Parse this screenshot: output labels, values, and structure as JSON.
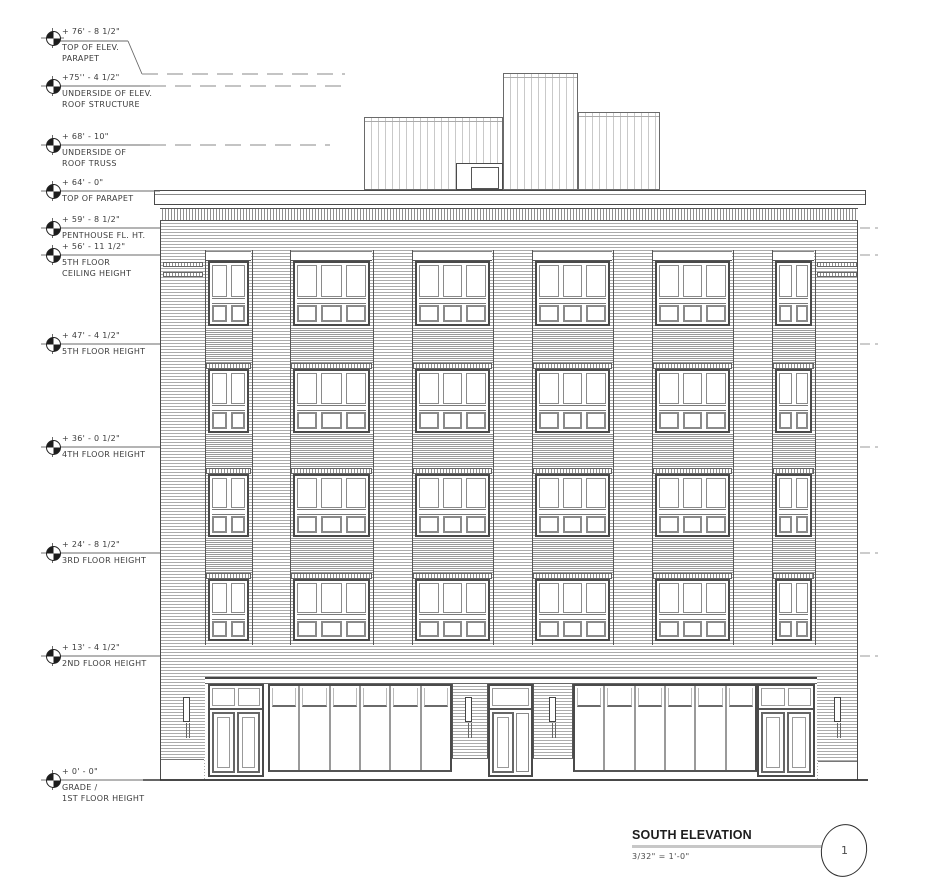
{
  "title_block": {
    "title": "SOUTH ELEVATION",
    "scale": "3/32\" = 1'-0\"",
    "bubble_number": "1"
  },
  "elevation_markers": [
    {
      "value": "+ 76' - 8 1/2\"",
      "lines": [
        "TOP OF ELEV.",
        "PARAPET"
      ],
      "y": 74,
      "leader": "roof",
      "end_x": 345
    },
    {
      "value": "+75'' - 4 1/2\"",
      "lines": [
        "UNDERSIDE OF ELEV.",
        "ROOF STRUCTURE"
      ],
      "y": 86,
      "leader": "dashed",
      "end_x": 345
    },
    {
      "value": "+ 68' - 10\"",
      "lines": [
        "UNDERSIDE OF",
        "ROOF TRUSS"
      ],
      "y": 145,
      "leader": "dashed",
      "end_x": 330
    },
    {
      "value": "+ 64' - 0\"",
      "lines": [
        "TOP OF PARAPET"
      ],
      "y": 191,
      "leader": "solid",
      "end_x": 160
    },
    {
      "value": "+ 59' - 8 1/2\"",
      "lines": [
        "PENTHOUSE FL. HT."
      ],
      "y": 228,
      "leader": "solid",
      "end_x": 160
    },
    {
      "value": "+ 56' - 11 1/2\"",
      "lines": [
        "5TH FLOOR",
        "CEILING HEIGHT"
      ],
      "y": 255,
      "leader": "solid",
      "end_x": 160
    },
    {
      "value": "+ 47' - 4 1/2\"",
      "lines": [
        "5TH FLOOR HEIGHT"
      ],
      "y": 344,
      "leader": "solid",
      "end_x": 160
    },
    {
      "value": "+ 36' - 0 1/2\"",
      "lines": [
        "4TH FLOOR HEIGHT"
      ],
      "y": 447,
      "leader": "solid",
      "end_x": 160
    },
    {
      "value": "+ 24' - 8 1/2\"",
      "lines": [
        "3RD FLOOR HEIGHT"
      ],
      "y": 553,
      "leader": "solid",
      "end_x": 160
    },
    {
      "value": "+ 13' - 4 1/2\"",
      "lines": [
        "2ND FLOOR HEIGHT"
      ],
      "y": 656,
      "leader": "solid",
      "end_x": 160
    },
    {
      "value": "+ 0' - 0\"",
      "lines": [
        "GRADE /",
        "1ST FLOOR HEIGHT"
      ],
      "y": 780,
      "leader": "solid",
      "end_x": 160
    }
  ],
  "right_level_ticks": [
    228,
    255,
    344,
    447,
    553,
    656
  ],
  "colors": {
    "ink": "#3c3c3c",
    "hatch": "#ababab",
    "title_rule": "#c7c7c7"
  }
}
